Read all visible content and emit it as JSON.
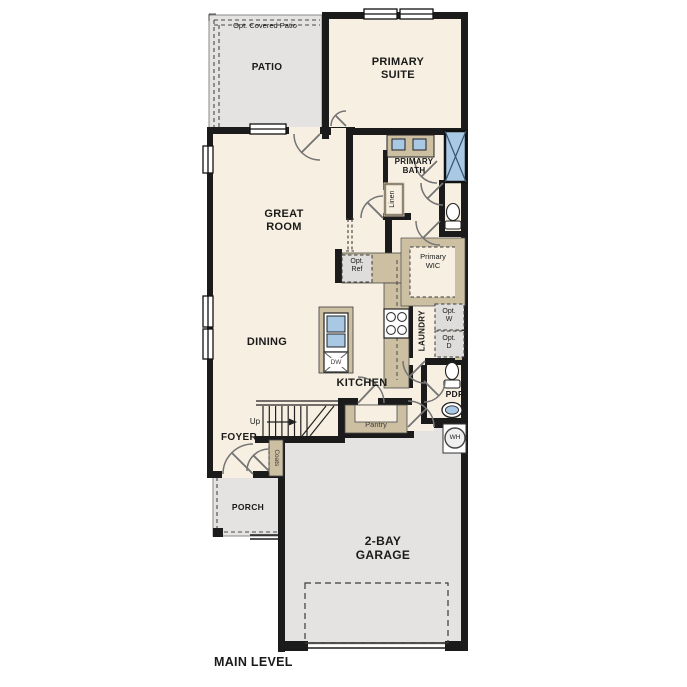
{
  "plan": {
    "level_title": "MAIN LEVEL"
  },
  "rooms": {
    "patio_note": "Opt. Covered Patio",
    "patio": "PATIO",
    "primary_suite": "PRIMARY SUITE",
    "great_room": "GREAT ROOM",
    "primary_bath": "PRIMARY BATH",
    "linen": "Linen",
    "primary_wic": "Primary WIC",
    "dining": "DINING",
    "kitchen": "KITCHEN",
    "laundry": "LAUNDRY",
    "powder_room": "PDR",
    "foyer": "FOYER",
    "coats": "Coats",
    "pantry": "Pantry",
    "porch": "PORCH",
    "garage": "2-BAY GARAGE"
  },
  "fixtures": {
    "optional_refrigerator": "Opt. Ref",
    "optional_washer": "Opt. W",
    "optional_dryer": "Opt. D",
    "dishwasher": "DW",
    "water_heater": "WH",
    "stairs_direction": "Up"
  },
  "icons": {
    "shower": "x-pattern-rect",
    "toilet": "bowl-and-tank",
    "double-vanity-sink": "two-blue-basins",
    "kitchen-sink": "two-blue-basins",
    "range": "four-burner-circles",
    "water-heater": "circle-wh",
    "stairs": "treads-with-up-arrow",
    "door": "quarter-arc-swing",
    "window": "double-line-rect"
  },
  "colors": {
    "floor_interior": "#f7f0e2",
    "floor_outdoor": "#e4e3e1",
    "counter_tan": "#cdbfa2",
    "fixture_blue": "#a9c8e4",
    "wall_black": "#1b1b1b",
    "door_arc_gray": "#757575",
    "dashed_gray": "#4a4a4a"
  }
}
